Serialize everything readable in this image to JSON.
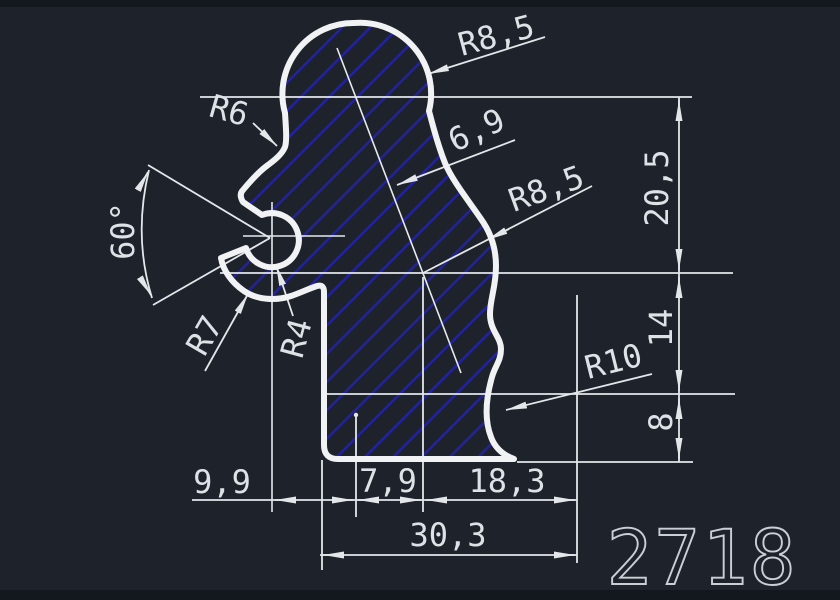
{
  "window": {
    "background_color": "#1e232b",
    "letterbox_color": "#13171e"
  },
  "drawing": {
    "part_number": "2718",
    "colors": {
      "profile_outline": "#f0f2f4",
      "dimension_lines": "#e3e7ea",
      "dimension_text": "#dde2e6",
      "hatch_blue": "#22229e",
      "part_number_gray": "#c9cfd5"
    },
    "hatch": {
      "style": "diagonal-lines-45deg",
      "spacing_px": 20,
      "line_width_px": 5
    },
    "dimensions": {
      "radius_head": "R8,5",
      "radius_neck": "R6",
      "wall_thickness": "6,9",
      "radius_right_bulge": "R8,5",
      "height_upper": "20,5",
      "slot_angle": "60°",
      "radius_hook_outer": "R7",
      "radius_hook_bore": "R4",
      "height_middle": "14",
      "radius_scallop": "R10",
      "height_lower": "8",
      "width_left": "9,9",
      "width_middle": "7,9",
      "width_right": "18,3",
      "width_total": "30,3"
    }
  }
}
